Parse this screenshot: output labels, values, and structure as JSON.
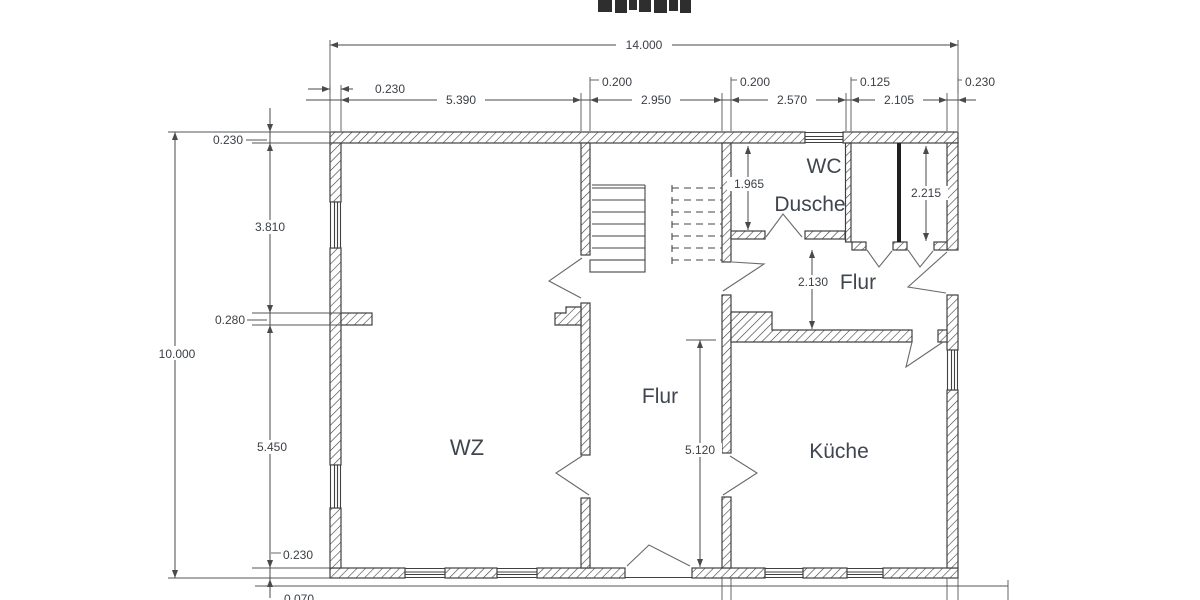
{
  "title_fragment_note": "clipped text at top edge",
  "colors": {
    "background": "#ffffff",
    "wall_line": "#404040",
    "dimension_line": "#4a4a4a",
    "text": "#3b4046",
    "room_text": "#3f4650",
    "partition_fill": "#1f1f1f"
  },
  "rooms": {
    "wc": "WC",
    "dusche": "Dusche",
    "flur_upper": "Flur",
    "flur_main": "Flur",
    "wz": "WZ",
    "kueche": "Küche"
  },
  "dimensions": {
    "overall_width": "14.000",
    "overall_height": "10.000",
    "top_chain": [
      "0.230",
      "5.390",
      "0.200",
      "2.950",
      "0.200",
      "2.570",
      "0.125",
      "2.105",
      "0.230"
    ],
    "left_chain": [
      "0.230",
      "3.810",
      "0.280",
      "5.450",
      "0.230"
    ],
    "interior": {
      "wc_depth": "1.965",
      "right_room_depth": "2.215",
      "flur_upper_width": "2.130",
      "flur_main_length": "5.120"
    },
    "bottom_partial": "0.070"
  }
}
